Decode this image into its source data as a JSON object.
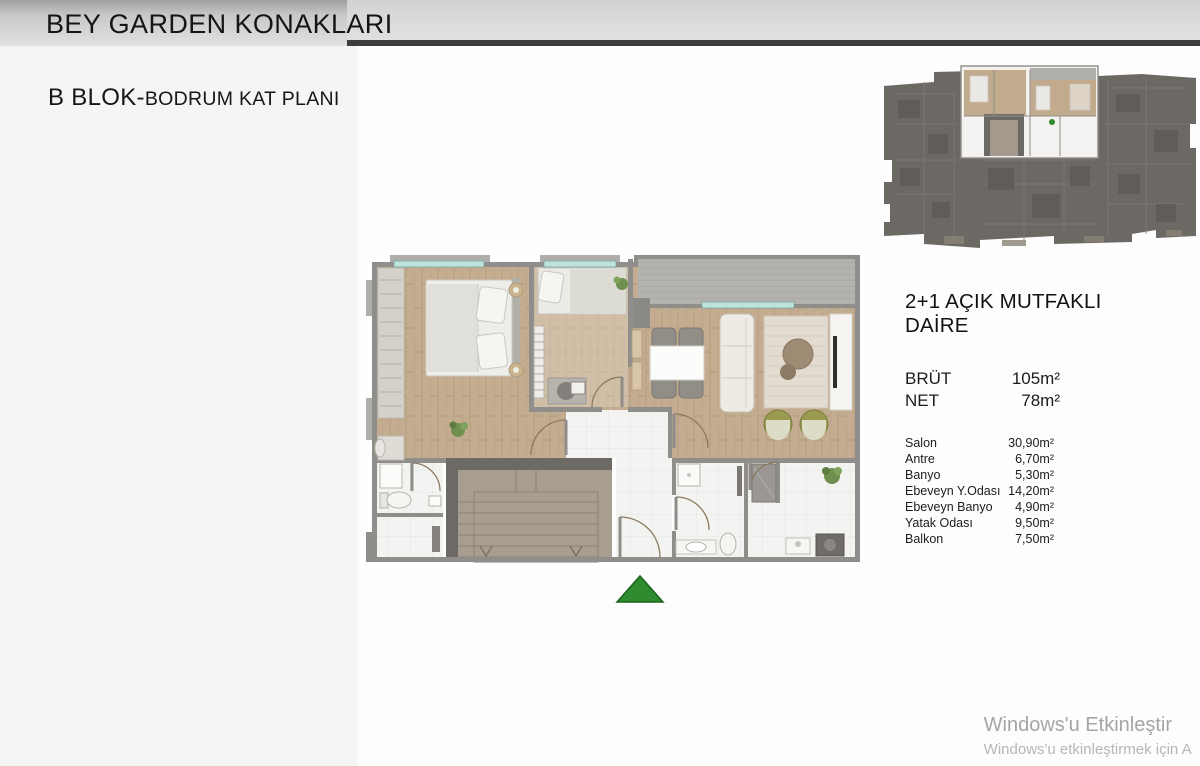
{
  "slide": {
    "title": "BEY GARDEN KONAKLARI",
    "subtitle_block": "B BLOK-",
    "subtitle_plan": "BODRUM KAT PLANI"
  },
  "apartment": {
    "type_title": "2+1 AÇIK MUTFAKLI DAİRE",
    "areas": [
      {
        "label": "BRÜT",
        "value": "105m²"
      },
      {
        "label": "NET",
        "value": "78m²"
      }
    ],
    "rooms": [
      {
        "label": "Salon",
        "value": "30,90m²"
      },
      {
        "label": "Antre",
        "value": "6,70m²"
      },
      {
        "label": "Banyo",
        "value": "5,30m²"
      },
      {
        "label": "Ebeveyn Y.Odası",
        "value": "14,20m²"
      },
      {
        "label": "Ebeveyn Banyo",
        "value": "4,90m²"
      },
      {
        "label": "Yatak Odası",
        "value": "9,50m²"
      },
      {
        "label": "Balkon",
        "value": "7,50m²"
      }
    ]
  },
  "floor_plan": {
    "icons": [
      "north-arrow-icon"
    ],
    "colors": {
      "wood_floor": "#c3ac8f",
      "tile_floor": "#f3f3f1",
      "wall": "#908e8a",
      "dark_wall": "#6d6a66",
      "window_glass": "#bfe2dc",
      "balcony_deck": "#b4b2ad",
      "north_arrow_green": "#2e8b2e",
      "armchair_olive": "#9a9b50",
      "overview_building": "#6c6965"
    }
  },
  "watermark": {
    "line1": "Windows'u Etkinleştir",
    "line2": "Windows'u etkinleştirmek için A"
  }
}
